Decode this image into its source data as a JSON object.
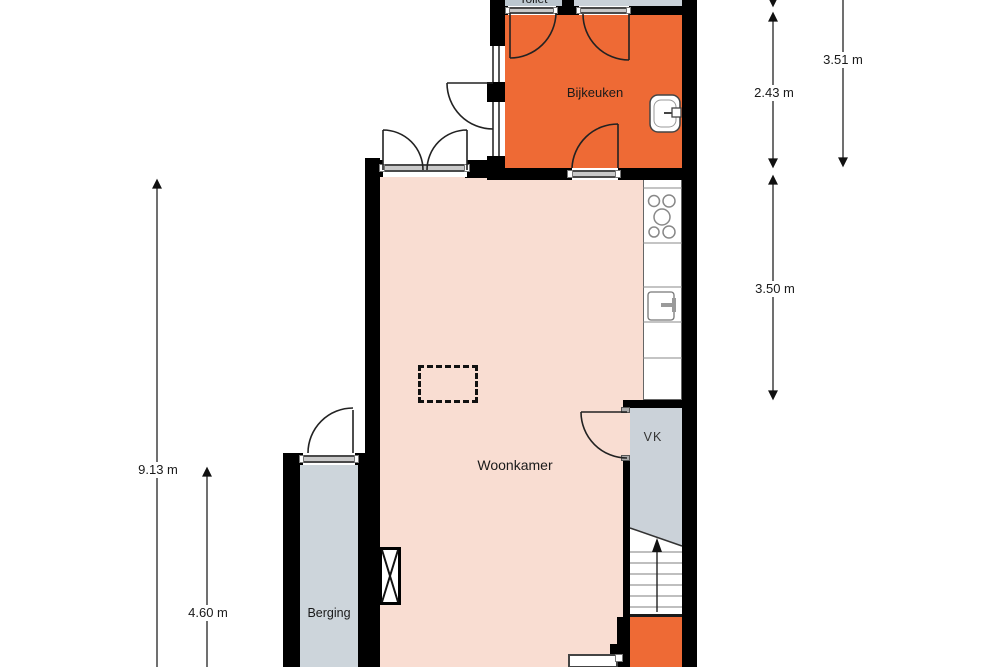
{
  "plan": {
    "title": "Floor plan ground floor",
    "rooms": [
      {
        "name": "Toilet"
      },
      {
        "name": "Bijkeuken"
      },
      {
        "name": "Woonkamer"
      },
      {
        "name": "VK"
      },
      {
        "name": "Berging"
      }
    ],
    "dimensions": [
      {
        "label": "3.51 m"
      },
      {
        "label": "2.43 m"
      },
      {
        "label": "3.50 m"
      },
      {
        "label": "9.13 m"
      },
      {
        "label": "4.60 m"
      }
    ],
    "colors": {
      "utility_orange": "#EE6A35",
      "living_pink": "#F9DDD2",
      "secondary_gray": "#C9D1D8",
      "wall": "#000000",
      "dimension_text": "#111111"
    },
    "icons": [
      "sink-icon",
      "stove-icon",
      "stairs-up-arrow-icon",
      "flue-icon",
      "door-arc-icon",
      "dimension-arrow-icon"
    ]
  }
}
